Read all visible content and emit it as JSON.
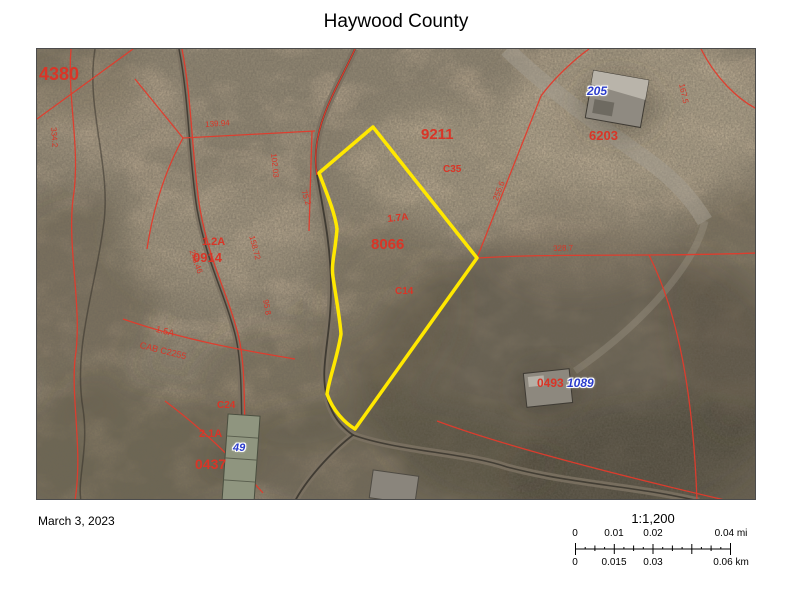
{
  "title": "Haywood County",
  "footer": {
    "date": "March 3, 2023"
  },
  "scale": {
    "ratio": "1:1,200",
    "mi_labels": [
      {
        "text": "0",
        "pct": 0
      },
      {
        "text": "0.01",
        "pct": 25
      },
      {
        "text": "0.02",
        "pct": 50
      },
      {
        "text": "0.04 mi",
        "pct": 100
      }
    ],
    "km_labels": [
      {
        "text": "0",
        "pct": 0
      },
      {
        "text": "0.015",
        "pct": 25
      },
      {
        "text": "0.03",
        "pct": 50
      },
      {
        "text": "0.06 km",
        "pct": 100
      }
    ]
  },
  "colors": {
    "parcel_text": "#d93527",
    "parcel_line": "#e23b2c",
    "address_label": "#2b3ccc",
    "highlight_outline": "#ffe800",
    "terrain_base": "#b2a28a"
  },
  "map": {
    "labels": [
      {
        "name": "parcel-4380",
        "text": "4380",
        "x": 2,
        "y": 16,
        "size": 18,
        "bold": true
      },
      {
        "name": "parcel-9211",
        "text": "9211",
        "x": 384,
        "y": 78,
        "size": 15,
        "bold": true
      },
      {
        "name": "parcel-8066",
        "text": "8066",
        "x": 334,
        "y": 188,
        "size": 15,
        "bold": true
      },
      {
        "name": "acreage-1-2a",
        "text": "1.2A",
        "x": 165,
        "y": 188,
        "size": 11,
        "bold": true
      },
      {
        "name": "parcel-0914",
        "text": "0914",
        "x": 156,
        "y": 202,
        "size": 13,
        "bold": true
      },
      {
        "name": "parcel-c35",
        "text": "C35",
        "x": 406,
        "y": 116,
        "size": 10,
        "bold": true
      },
      {
        "name": "parcel-c14",
        "text": "C14",
        "x": 358,
        "y": 238,
        "size": 10,
        "bold": true
      },
      {
        "name": "parcel-6203",
        "text": "6203",
        "x": 552,
        "y": 80,
        "size": 13,
        "bold": true
      },
      {
        "name": "parcel-0493",
        "text": "0493",
        "x": 500,
        "y": 328,
        "size": 12,
        "bold": true
      },
      {
        "name": "acreage-2-1a",
        "text": "2.1A",
        "x": 162,
        "y": 380,
        "size": 11,
        "bold": true
      },
      {
        "name": "parcel-0437",
        "text": "0437",
        "x": 158,
        "y": 408,
        "size": 14,
        "bold": true
      },
      {
        "name": "parcel-c24",
        "text": "C24",
        "x": 180,
        "y": 352,
        "size": 10,
        "bold": true
      },
      {
        "name": "acreage-1-7a",
        "text": "1.7A",
        "x": 350,
        "y": 166,
        "size": 10,
        "rotate": -6,
        "bold": true
      },
      {
        "name": "plat-area-1-5a",
        "text": "1.5A",
        "x": 120,
        "y": 276,
        "size": 9,
        "rotate": 14
      },
      {
        "name": "plat-cab-c2255",
        "text": "CAB C2255",
        "x": 104,
        "y": 292,
        "size": 9,
        "rotate": 14
      },
      {
        "name": "dim-139-94",
        "text": "139.94",
        "x": 168,
        "y": 72,
        "size": 8,
        "rotate": -4
      },
      {
        "name": "dim-102-03",
        "text": "102.03",
        "x": 240,
        "y": 104,
        "size": 8,
        "rotate": 84
      },
      {
        "name": "dim-75-2",
        "text": "75.2",
        "x": 270,
        "y": 140,
        "size": 8,
        "rotate": 72
      },
      {
        "name": "dim-158-72",
        "text": "158.72",
        "x": 218,
        "y": 186,
        "size": 8,
        "rotate": 75
      },
      {
        "name": "dim-95-8",
        "text": "95.8",
        "x": 232,
        "y": 250,
        "size": 8,
        "rotate": 80
      },
      {
        "name": "dim-248-46",
        "text": "248.46",
        "x": 158,
        "y": 200,
        "size": 8,
        "rotate": 70
      },
      {
        "name": "dim-255-6",
        "text": "255.6",
        "x": 455,
        "y": 150,
        "size": 8,
        "rotate": -69
      },
      {
        "name": "dim-328-7",
        "text": "328.7",
        "x": 516,
        "y": 196,
        "size": 8,
        "rotate": -2
      },
      {
        "name": "dim-334-2",
        "text": "334.2",
        "x": 20,
        "y": 78,
        "size": 8,
        "rotate": 86
      },
      {
        "name": "dim-167-5",
        "text": "167.5",
        "x": 648,
        "y": 34,
        "size": 8,
        "rotate": 78
      },
      {
        "name": "address-205",
        "text": "205",
        "x": 550,
        "y": 36,
        "size": 12,
        "color": "blue",
        "halo": true
      },
      {
        "name": "address-1089",
        "text": "1089",
        "x": 530,
        "y": 328,
        "size": 12,
        "color": "blue",
        "halo": true
      },
      {
        "name": "address-49",
        "text": "49",
        "x": 196,
        "y": 394,
        "size": 11,
        "color": "blue",
        "halo": true
      }
    ]
  }
}
